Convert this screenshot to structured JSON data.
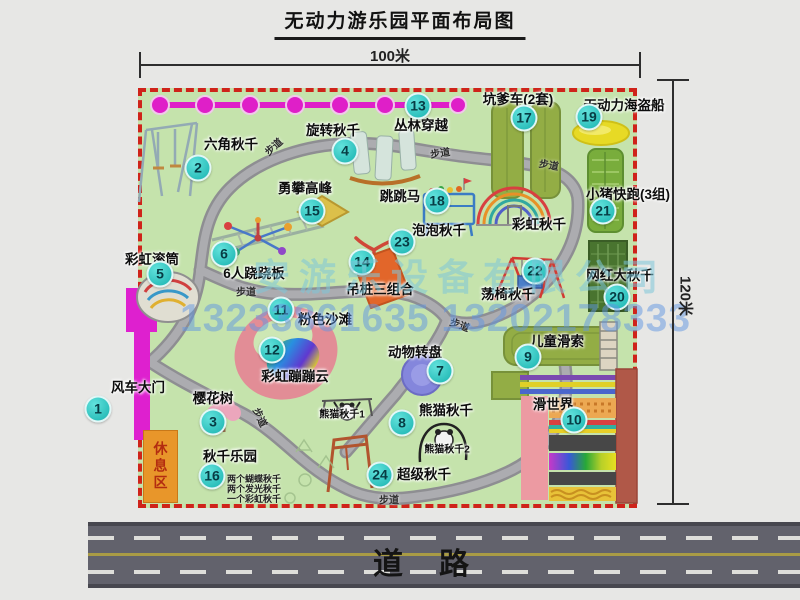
{
  "title": "无动力游乐园平面布局图",
  "dimensions": {
    "width": "100米",
    "height": "120米"
  },
  "road_label": "道路",
  "rest_area": "休息区",
  "path_label": "步道",
  "watermark": {
    "company": "安游乐设备有限公司",
    "phone": "13233861635 13202178333"
  },
  "colors": {
    "park_green": "#c5e3ac",
    "border_red": "#cf231a",
    "badge_teal": "#18b2af",
    "road_gray": "#62626c",
    "gate_magenta": "#de20cf",
    "rest_area_orange": "#e8962a"
  },
  "attractions": [
    {
      "num": 1,
      "name": "风车大门"
    },
    {
      "num": 2,
      "name": "六角秋千"
    },
    {
      "num": 3,
      "name": "樱花树"
    },
    {
      "num": 4,
      "name": "旋转秋千"
    },
    {
      "num": 5,
      "name": "彩虹滚筒"
    },
    {
      "num": 6,
      "name": "6人跷跷板"
    },
    {
      "num": 7,
      "name": "动物转盘"
    },
    {
      "num": 8,
      "name": "熊猫秋千"
    },
    {
      "num": 9,
      "name": "儿童滑索"
    },
    {
      "num": 10,
      "name": "滑世界"
    },
    {
      "num": 11,
      "name": "粉色沙滩"
    },
    {
      "num": 12,
      "name": "彩虹蹦蹦云"
    },
    {
      "num": 13,
      "name": "丛林穿越"
    },
    {
      "num": 14,
      "name": "吊桩三组合"
    },
    {
      "num": 15,
      "name": "勇攀高峰"
    },
    {
      "num": 16,
      "name": "秋千乐园"
    },
    {
      "num": 17,
      "name": "坑爹车(2套)"
    },
    {
      "num": 18,
      "name": "跳跳马"
    },
    {
      "num": 19,
      "name": "无动力海盗船"
    },
    {
      "num": 20,
      "name": "网红大秋千"
    },
    {
      "num": 21,
      "name": "小猪快跑(3组)"
    },
    {
      "num": 22,
      "name": "荡椅秋千"
    },
    {
      "num": 23,
      "name": "泡泡秋千"
    },
    {
      "num": 24,
      "name": "超级秋千"
    }
  ],
  "annotations": {
    "rainbow_swing": "彩虹秋千",
    "panda_swing_1": "熊猫秋千1",
    "panda_swing_2": "熊猫秋千2",
    "swing_park_notes": [
      "两个蝴蝶秋千",
      "两个发光秋千",
      "一个彩虹秋千"
    ]
  }
}
